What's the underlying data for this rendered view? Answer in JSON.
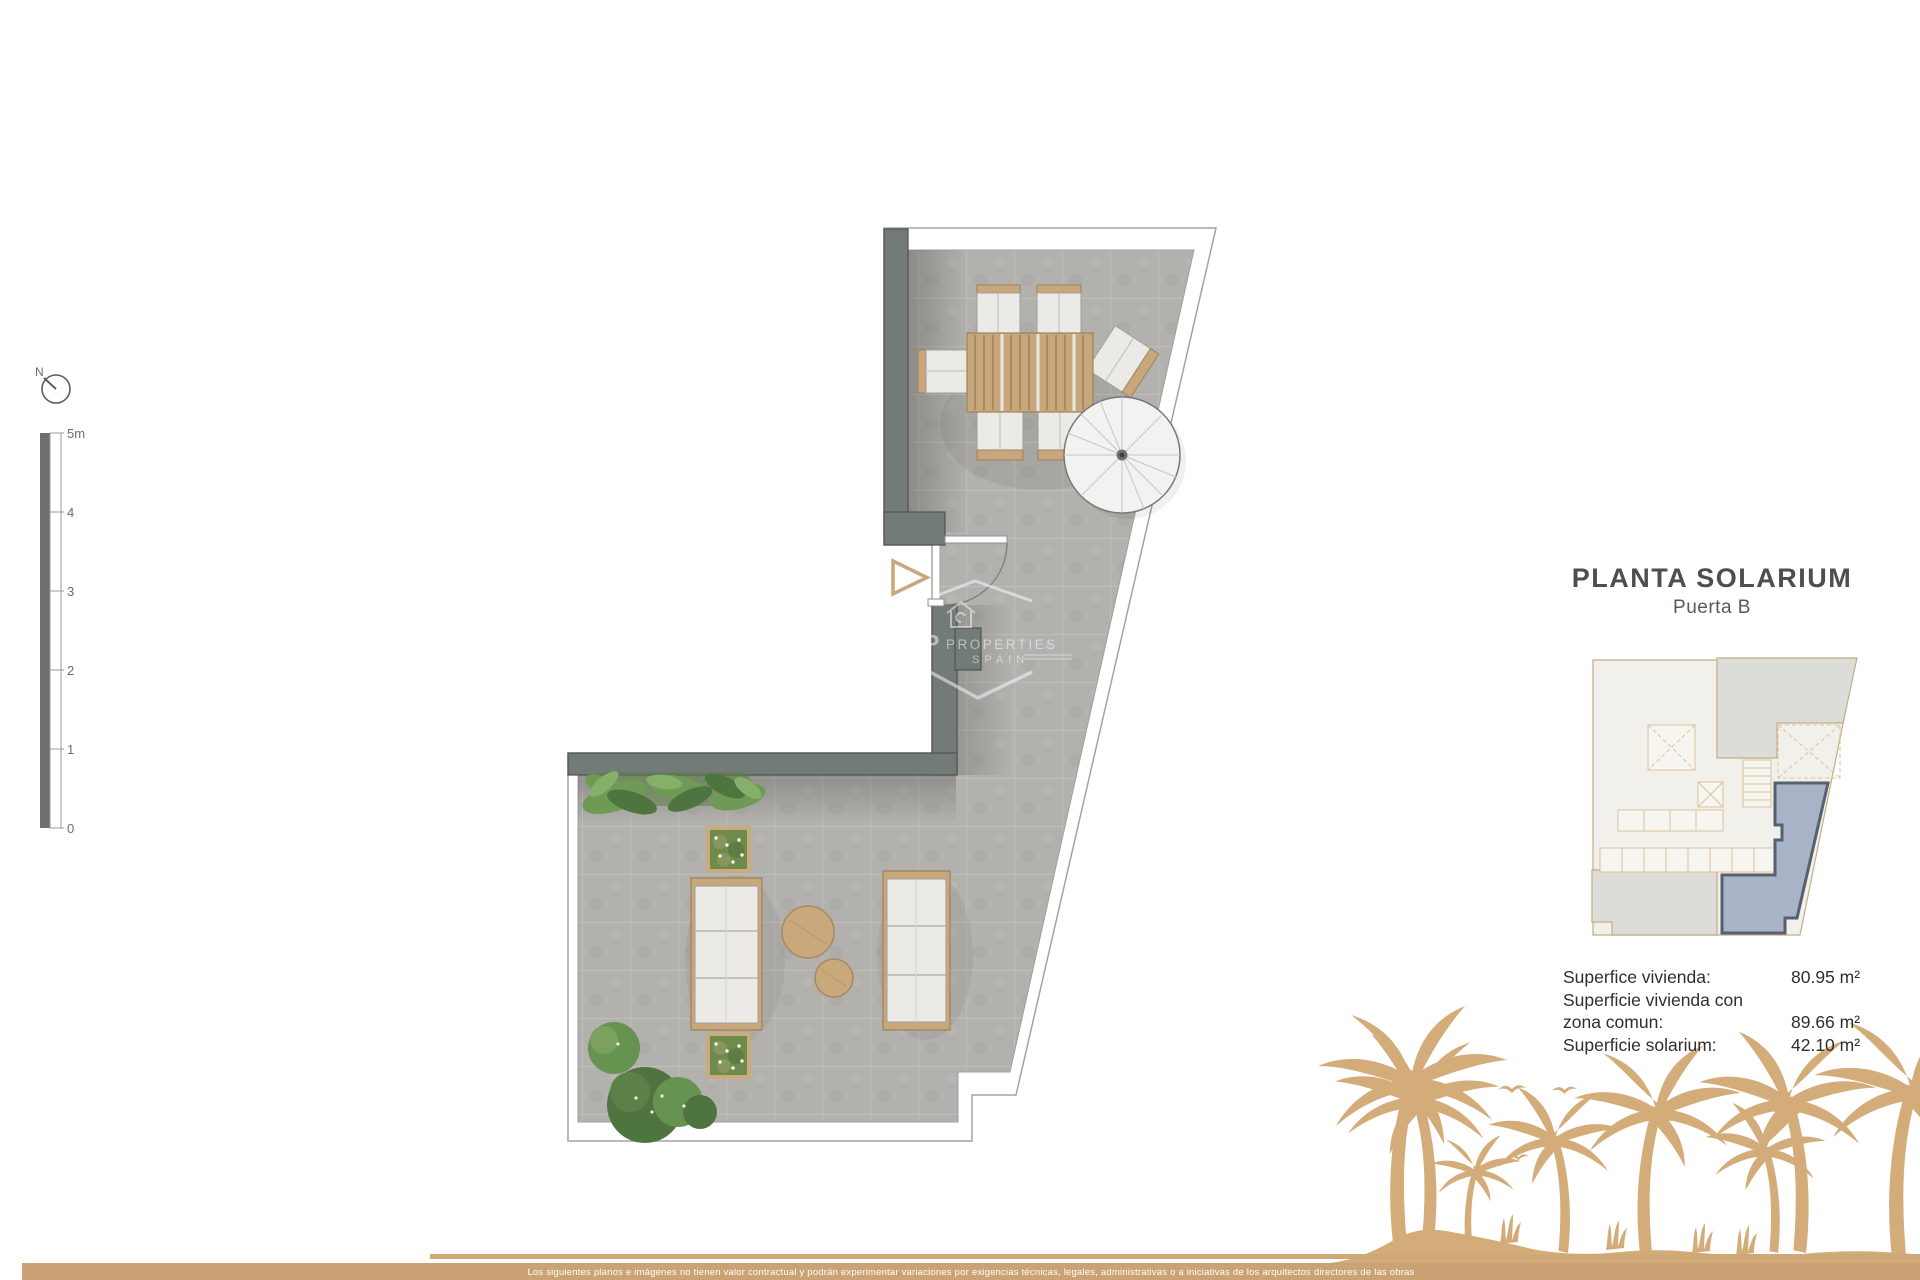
{
  "compass": {
    "north_label": "N"
  },
  "scale_bar": {
    "labels": [
      "5m",
      "4",
      "3",
      "2",
      "1",
      "0"
    ]
  },
  "panel": {
    "title": "PLANTA SOLARIUM",
    "subtitle": "Puerta B",
    "areas": [
      {
        "label": "Superfice vivienda:",
        "value": "80.95 m²"
      },
      {
        "label": "Superficie vivienda con",
        "value": ""
      },
      {
        "label": "zona comun:",
        "value": "89.66 m²"
      },
      {
        "label": "Superficie solarium:",
        "value": "42.10 m²"
      }
    ]
  },
  "watermark": {
    "monogram": "P",
    "name": "PROPERTIES",
    "country": "SPAIN"
  },
  "footer": {
    "disclaimer": "Los siguientes planos e imágenes no tienen valor contractual y podrán experimentar variaciones por exigencias técnicas, legales, administrativas o a iniciativas de los arquitectos directores de las obras"
  },
  "colors": {
    "wall": "#727b78",
    "tile": "#b3b1ad",
    "wood": "#c7a77b",
    "highlight_unit": "#a9b3c7",
    "palm_tan": "#d4ac7a",
    "footer_tan": "#cba273"
  }
}
